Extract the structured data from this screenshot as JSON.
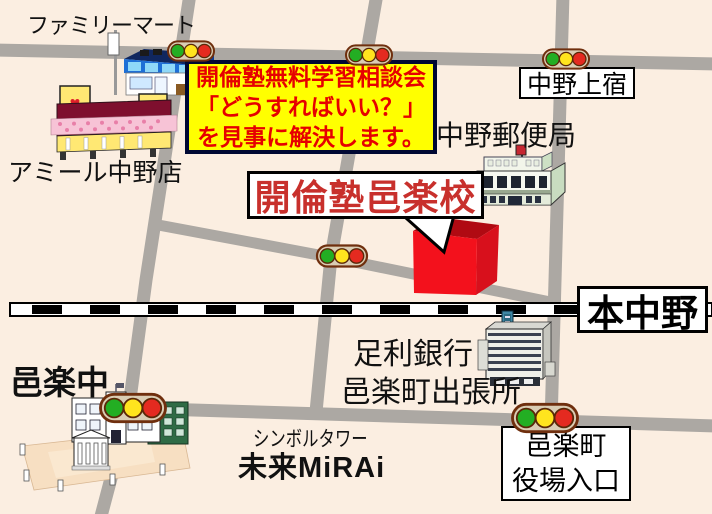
{
  "labels": {
    "familymart": "ファミリーマート",
    "amiru": "アミール中野店",
    "nakano_kamijuku": "中野上宿",
    "nakano_post_office": "中野郵便局",
    "kairin_school": "開倫塾邑楽校",
    "hon_nakano": "本中野",
    "ashikaga_bank_line1": "足利銀行",
    "ashikaga_bank_line2": "邑楽町出張所",
    "oura_junior_high": "邑楽中",
    "symbol_tower": "シンボルタワー",
    "mirai": "未来MiRAi",
    "yakuba_line1": "邑楽町",
    "yakuba_line2": "役場入口"
  },
  "promo": {
    "line1": "開倫塾無料学習相談会",
    "line2": "「どうすればいい？」",
    "line3": "を見事に解決します。",
    "bg": "#FFFF00",
    "text_color": "#E60000"
  },
  "icons": {
    "heart": "♥"
  },
  "colors": {
    "background": "#FBEEE1",
    "road": "#ACA8A3",
    "railway_black": "#000000",
    "railway_white": "#FFFFFF",
    "school_red": "#F3111C",
    "callout_red_text": "#C8302C",
    "signal_green": "#23AE23",
    "signal_yellow": "#FFE41E",
    "signal_red": "#E42A20",
    "signal_housing": "#DACDB4"
  }
}
